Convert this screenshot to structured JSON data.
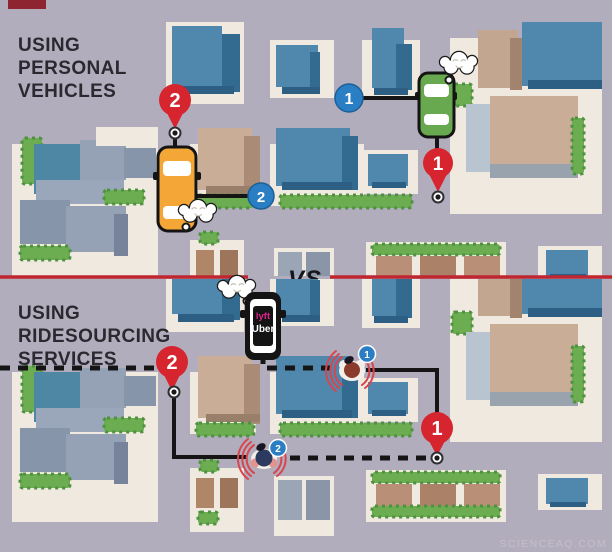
{
  "watermark": "SCIENCEAQ.COM",
  "divider": {
    "vs_label": "VS"
  },
  "personal_scene": {
    "title_lines": [
      "USING",
      "PERSONAL",
      "VEHICLES"
    ],
    "rider1_badge": "1",
    "rider2_badge": "2",
    "destination1_pin": "1",
    "destination2_pin": "2"
  },
  "ridesourcing_scene": {
    "title_lines": [
      "USING",
      "RIDESOURCING",
      "SERVICES"
    ],
    "rider1_badge": "1",
    "rider2_badge": "2",
    "destination1_pin": "1",
    "destination2_pin": "2",
    "car_brands": {
      "lyft": "lyft",
      "uber": "Uber"
    }
  },
  "colors": {
    "road": "#b2adbd",
    "block": "#efe9df",
    "building_blue": "#4f88ac",
    "building_blue_dark": "#336b90",
    "building_tan": "#c9ad96",
    "building_tan_dark": "#aa8c76",
    "building_gray": "#95a2b5",
    "hedge_green": "#6cad52",
    "pin_red": "#d6252f",
    "badge_blue": "#2a7ec4",
    "route_black": "#151515",
    "divider_red": "#bf2630",
    "car_orange": "#f4a636",
    "car_green": "#68a94f",
    "car_black": "#141414",
    "lyft_magenta": "#e0218a",
    "signal_red": "#d9454f",
    "title_text": "#2a2930",
    "watermark_gray": "#c9bfc9"
  }
}
